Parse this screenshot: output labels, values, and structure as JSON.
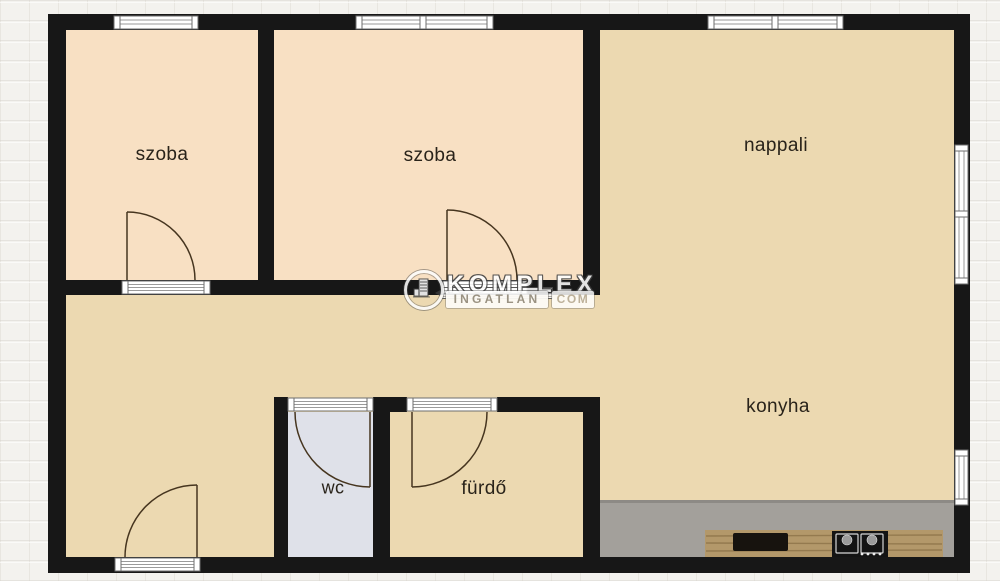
{
  "plan": {
    "rooms": [
      {
        "id": "szoba-1",
        "label": "szoba"
      },
      {
        "id": "szoba-2",
        "label": "szoba"
      },
      {
        "id": "nappali",
        "label": "nappali"
      },
      {
        "id": "konyha",
        "label": "konyha"
      },
      {
        "id": "wc",
        "label": "wc"
      },
      {
        "id": "furdo",
        "label": "fürdő"
      }
    ]
  },
  "watermark": {
    "brand": "KOMPLEX",
    "portal": "INGATLAN",
    "tld": "COM"
  },
  "colors": {
    "wall": "#171717",
    "room_peach": "#f8e0c3",
    "room_tan": "#ecd9b1",
    "wc_floor": "#dfe1e9",
    "counter": "#a3a09b",
    "cabinet_wood": "#b3986a",
    "background": "#f3f2ee",
    "door_arc": "#46351f"
  }
}
